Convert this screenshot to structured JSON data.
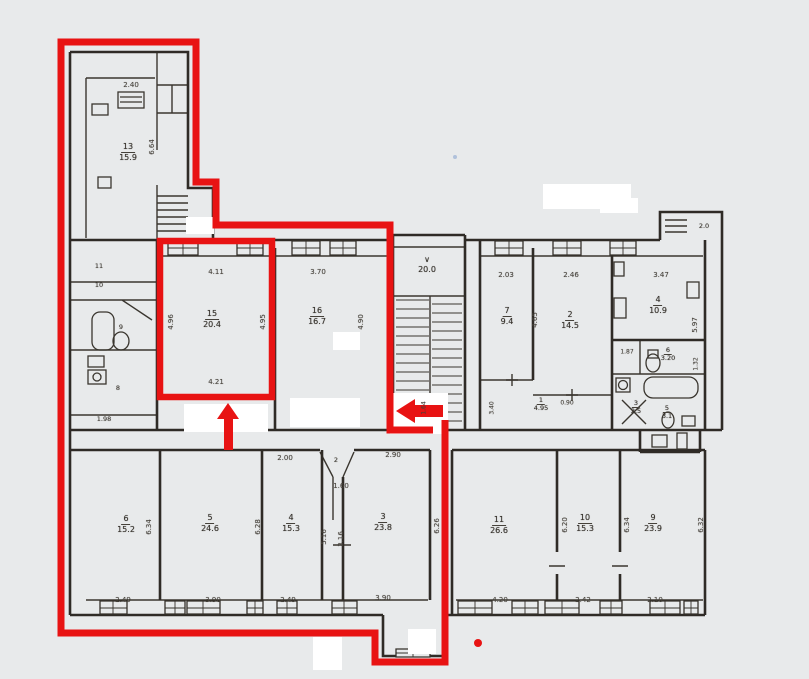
{
  "palette": {
    "background": "#e8eaeb",
    "ink": "#35312b",
    "annotation_red": "#e81313",
    "whiteout": "#ffffff",
    "speck_blue": "#9db3d6"
  },
  "stair": {
    "mark": "∨",
    "area": "20.0"
  },
  "exterior": {
    "porch_dim": "2.0"
  },
  "hall2": {
    "num": "2"
  },
  "left_cells": [
    "11",
    "10",
    "9",
    "8",
    "1.98"
  ],
  "rooms": [
    {
      "num": "13",
      "area": "15.9"
    },
    {
      "num": "15",
      "area": "20.4"
    },
    {
      "num": "16",
      "area": "16.7"
    },
    {
      "num": "7",
      "area": "9.4"
    },
    {
      "num": "2",
      "area": "14.5"
    },
    {
      "num": "4",
      "area": "10.9"
    },
    {
      "num": "6",
      "area": "3.20"
    },
    {
      "num": "3",
      "area": "2.5"
    },
    {
      "num": "5",
      "area": "3.1"
    },
    {
      "num": "1",
      "area": "4.95"
    },
    {
      "num": "6",
      "area": "15.2"
    },
    {
      "num": "5",
      "area": "24.6"
    },
    {
      "num": "4",
      "area": "15.3"
    },
    {
      "num": "3",
      "area": "23.8"
    },
    {
      "num": "11",
      "area": "26.6"
    },
    {
      "num": "10",
      "area": "15.3"
    },
    {
      "num": "9",
      "area": "23.9"
    }
  ],
  "dims_h": [
    "2.40",
    "4.11",
    "3.70",
    "4.21",
    "2.03",
    "2.46",
    "3.47",
    "1.87",
    "0.90",
    "2.00",
    "2.90",
    "1.60",
    "2.49",
    "3.90",
    "2.49",
    "3.90",
    "4.20",
    "2.42",
    "2.10"
  ],
  "dims_v": [
    "6.64",
    "4.96",
    "4.95",
    "4.90",
    "4.65",
    "5.97",
    "1.32",
    "1.64",
    "3.40",
    "6.34",
    "6.28",
    "5.16",
    "3.16",
    "6.26",
    "6.20",
    "6.34",
    "6.32"
  ]
}
